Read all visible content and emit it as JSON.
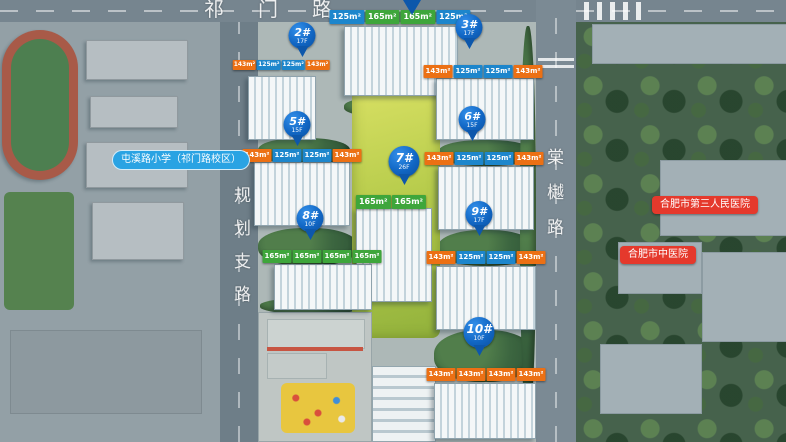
{
  "roads": {
    "top": "祁门路",
    "left": "规划支路",
    "right": "棠樾路"
  },
  "pois": {
    "school": {
      "label": "屯溪路小学（祁门路校区）",
      "color": "#2aa3e3"
    },
    "hospital_1": {
      "label": "合肥市第三人民医院",
      "color": "#e5392c"
    },
    "hospital_2": {
      "label": "合肥市中医院",
      "color": "#e5392c"
    }
  },
  "buildings": [
    {
      "id": "",
      "floors": "",
      "tags": [
        {
          "v": "125m²",
          "c": "blue"
        },
        {
          "v": "165m²",
          "c": "green"
        },
        {
          "v": "165m²",
          "c": "green"
        },
        {
          "v": "125m²",
          "c": "blue"
        }
      ]
    },
    {
      "id": "2#",
      "floors": "17F",
      "tags": [
        {
          "v": "143m²",
          "c": "orange"
        },
        {
          "v": "125m²",
          "c": "blue"
        },
        {
          "v": "125m²",
          "c": "blue"
        },
        {
          "v": "143m²",
          "c": "orange"
        }
      ]
    },
    {
      "id": "3#",
      "floors": "17F",
      "tags": [
        {
          "v": "143m²",
          "c": "orange"
        },
        {
          "v": "125m²",
          "c": "blue"
        },
        {
          "v": "125m²",
          "c": "blue"
        },
        {
          "v": "143m²",
          "c": "orange"
        }
      ]
    },
    {
      "id": "5#",
      "floors": "15F",
      "tags": [
        {
          "v": "143m²",
          "c": "orange"
        },
        {
          "v": "125m²",
          "c": "blue"
        },
        {
          "v": "125m²",
          "c": "blue"
        },
        {
          "v": "143m²",
          "c": "orange"
        }
      ]
    },
    {
      "id": "6#",
      "floors": "15F",
      "tags": [
        {
          "v": "143m²",
          "c": "orange"
        },
        {
          "v": "125m²",
          "c": "blue"
        },
        {
          "v": "125m²",
          "c": "blue"
        },
        {
          "v": "143m²",
          "c": "orange"
        }
      ]
    },
    {
      "id": "7#",
      "floors": "26F",
      "tags": [
        {
          "v": "165m²",
          "c": "green"
        },
        {
          "v": "165m²",
          "c": "green"
        }
      ]
    },
    {
      "id": "8#",
      "floors": "10F",
      "tags": [
        {
          "v": "165m²",
          "c": "green"
        },
        {
          "v": "165m²",
          "c": "green"
        },
        {
          "v": "165m²",
          "c": "green"
        },
        {
          "v": "165m²",
          "c": "green"
        }
      ]
    },
    {
      "id": "9#",
      "floors": "17F",
      "tags": [
        {
          "v": "143m²",
          "c": "orange"
        },
        {
          "v": "125m²",
          "c": "blue"
        },
        {
          "v": "125m²",
          "c": "blue"
        },
        {
          "v": "143m²",
          "c": "orange"
        }
      ]
    },
    {
      "id": "10#",
      "floors": "10F",
      "tags": [
        {
          "v": "143m²",
          "c": "orange"
        },
        {
          "v": "143m²",
          "c": "orange"
        },
        {
          "v": "143m²",
          "c": "orange"
        },
        {
          "v": "143m²",
          "c": "orange"
        }
      ]
    }
  ],
  "colors": {
    "tag_blue": "#1d86cc",
    "tag_green": "#3ea63b",
    "tag_orange": "#ec7014",
    "pin_blue": "#1166c4",
    "poi_red": "#e5392c",
    "poi_blue": "#2aa3e3"
  }
}
